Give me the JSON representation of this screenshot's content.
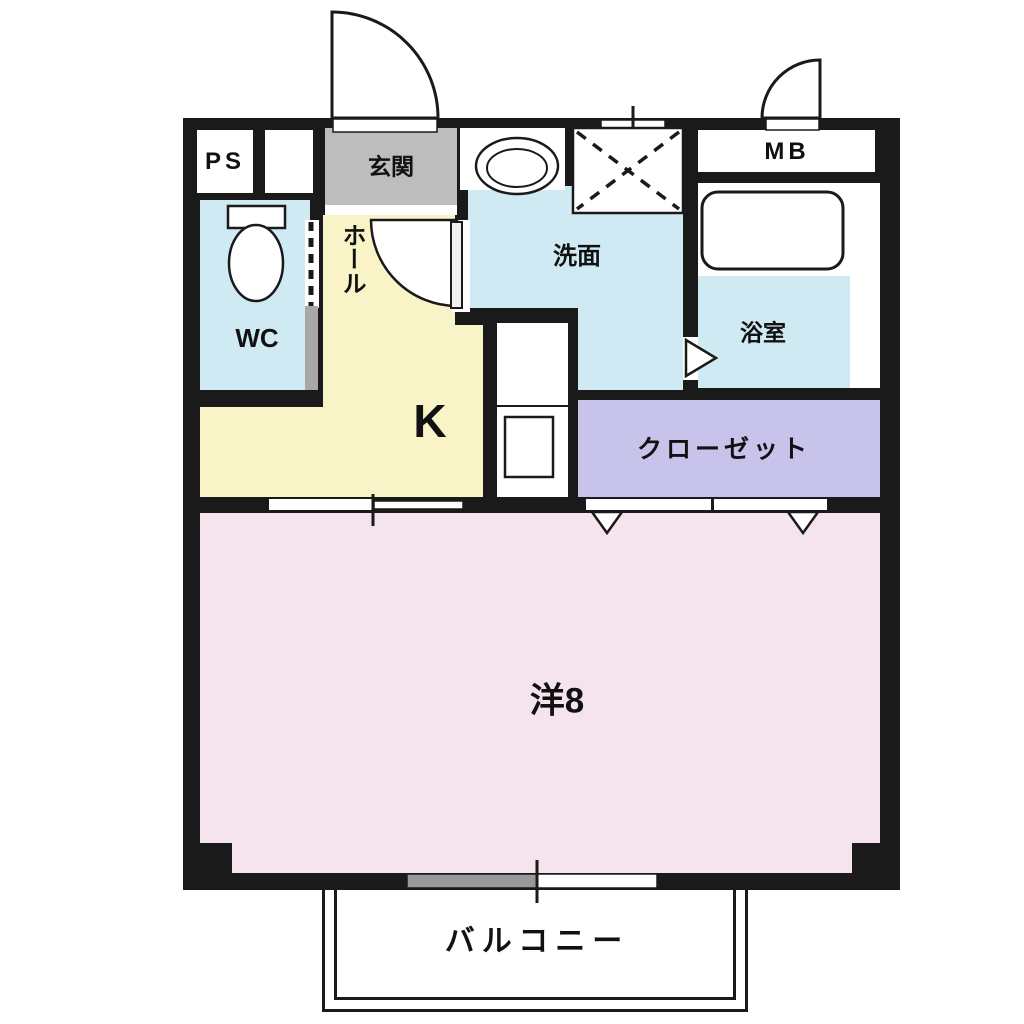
{
  "floorplan": {
    "type": "apartment-floor-plan",
    "rooms": {
      "ps": "PS",
      "entrance": "玄関",
      "meter_box": "MB",
      "toilet": "WC",
      "hall": "ホール",
      "washroom": "洗面",
      "bathroom": "浴室",
      "kitchen": "K",
      "closet": "クローゼット",
      "western_room": "洋8",
      "balcony": "バルコニー"
    },
    "colors": {
      "wall": "#1a1a1a",
      "entrance_floor": "#bdbdbd",
      "water_area": "#cfeaf2",
      "kitchen_hall": "#f8f4c8",
      "closet": "#c7c3ea",
      "western_room": "#f5e3ed",
      "window_shade": "#999999",
      "door_pocket": "#a8a8a8"
    }
  }
}
